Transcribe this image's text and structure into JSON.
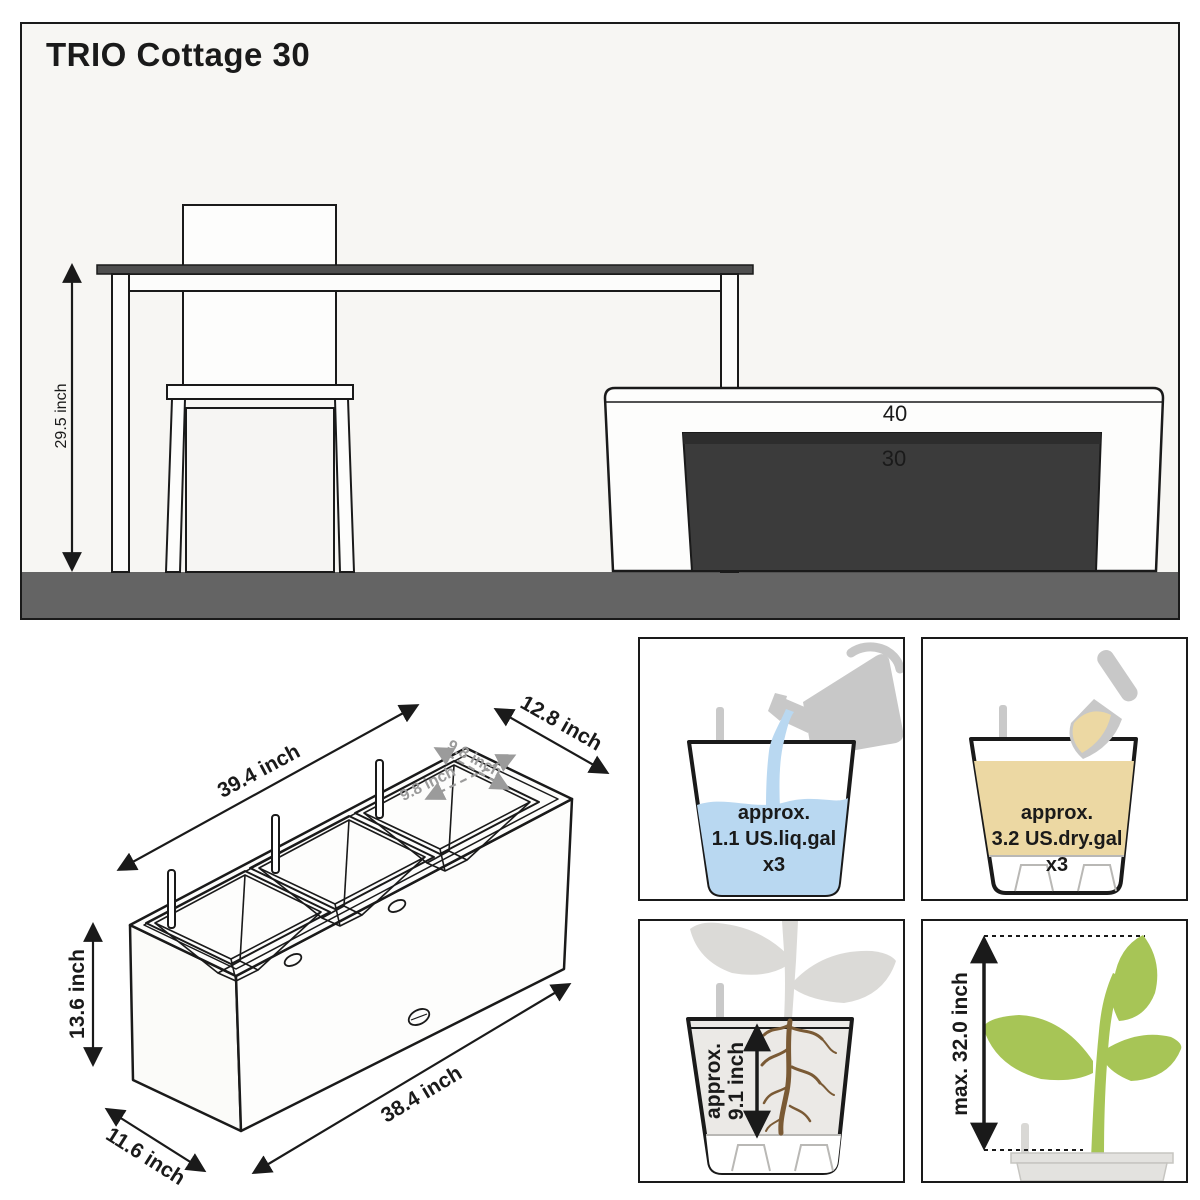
{
  "title": "TRIO Cottage 30",
  "scene": {
    "height_label": "29.5 inch",
    "large_planter_label": "40",
    "small_planter_label": "30"
  },
  "iso_dimensions": {
    "top_length": "39.4 inch",
    "top_depth": "12.8 inch",
    "inner_width": "9.8 inch",
    "inner_depth": "9.8 inch",
    "height": "13.6 inch",
    "bottom_length": "38.4 inch",
    "bottom_depth": "11.6 inch"
  },
  "info_boxes": {
    "water_capacity": {
      "line1": "approx.",
      "line2": "1.1 US.liq.gal",
      "line3": "x3",
      "icon": "watering-can-icon",
      "color": "#b9d8f1"
    },
    "soil_capacity": {
      "line1": "approx.",
      "line2": "3.2 US.dry.gal",
      "line3": "x3",
      "icon": "trowel-icon",
      "color": "#ecd8a3"
    },
    "planting_depth": {
      "line1": "approx.",
      "line2": "9.1 inch",
      "icon": "roots-icon",
      "color": "#7a5a35"
    },
    "max_plant_height": {
      "label": "max. 32.0 inch",
      "icon": "seedling-icon",
      "color": "#a7c556"
    }
  },
  "colors": {
    "panel_background": "#f7f6f3",
    "floor": "#646464",
    "tabletop": "#4e4e4e",
    "planter_dark": "#3b3b3b",
    "silhouette_gray": "#c8c8c8",
    "dimension_gray": "#9b9b9b",
    "ink": "#1a1a1a"
  }
}
